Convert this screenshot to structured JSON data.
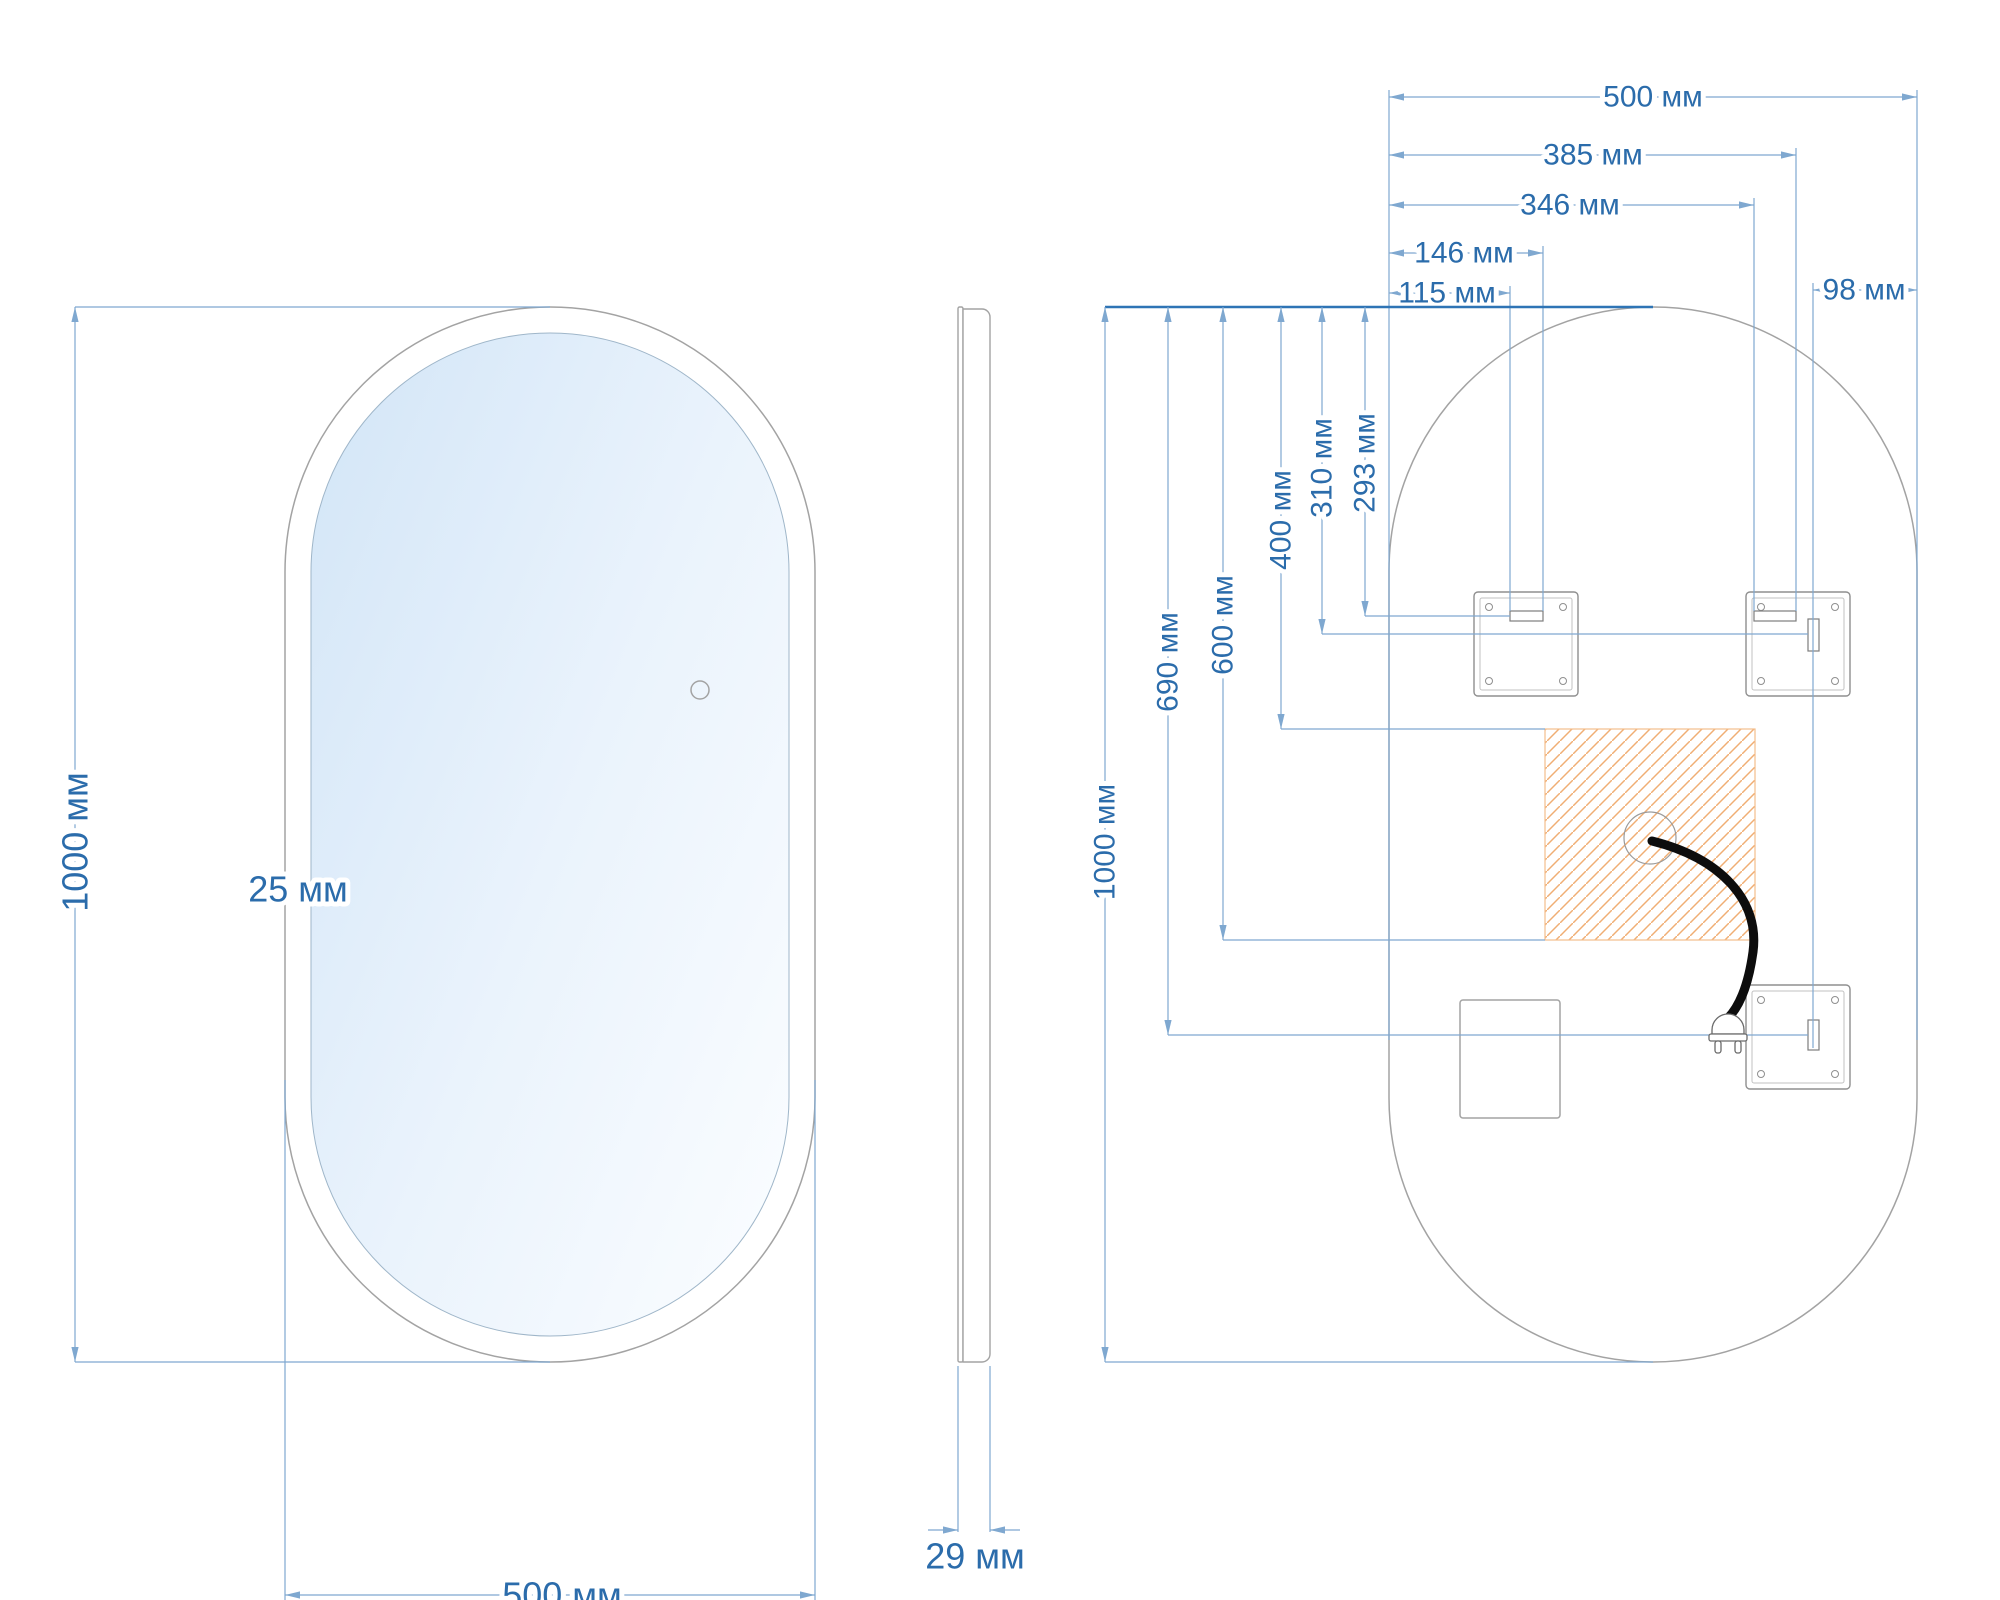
{
  "drawing": {
    "units": "мм",
    "front_view": {
      "height_label": "1000 мм",
      "width_label": "500 мм",
      "frame_width_label": "25 мм"
    },
    "side_view": {
      "depth_label": "29 мм"
    },
    "back_view": {
      "top_dims": {
        "full_width": "500 мм",
        "right_slot_outer": "385 мм",
        "right_slot_inner": "346 мм",
        "left_slot_outer": "146 мм",
        "left_slot_inner": "115 мм",
        "right_edge_offset": "98 мм"
      },
      "left_dims": {
        "full_height": "1000 мм",
        "bottom_slot": "690 мм",
        "junction_box_bottom": "600 мм",
        "junction_box_top": "400 мм",
        "right_slot": "310 мм",
        "left_slot": "293 мм"
      }
    },
    "colors": {
      "dim-line": "#7fa8d0",
      "dim-strong": "#2e74b5",
      "text": "#2b6cab",
      "outline": "#a3a3a3",
      "bracket": "#8f8f8f",
      "hatch": "#f0ae74",
      "hatch-border": "#f3bd8c",
      "cable": "#0d0d0d",
      "glass-top": "#d2e5f7",
      "glass-mid": "#eaf3fc",
      "glass-end": "#f9fcff"
    }
  }
}
